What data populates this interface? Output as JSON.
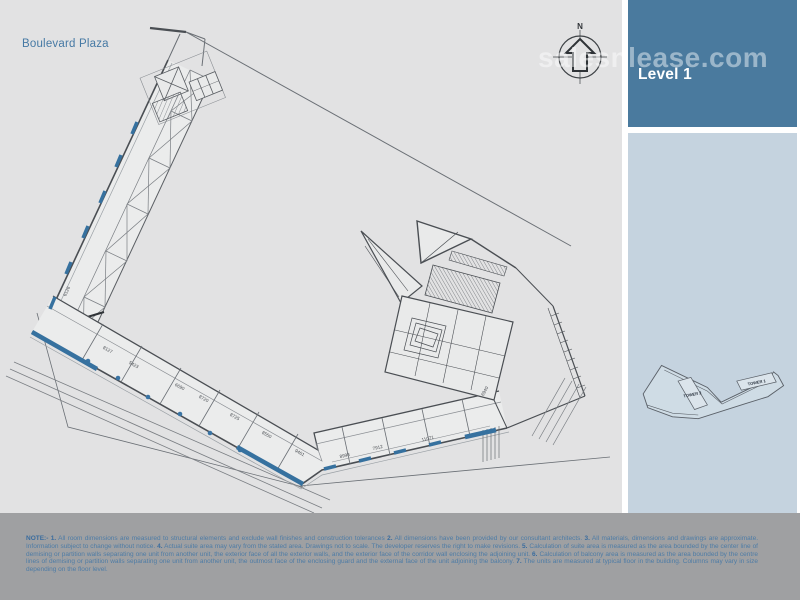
{
  "header": {
    "project_name": "Boulevard Plaza",
    "watermark": "salesnlease.com"
  },
  "sidebar": {
    "level_label": "Level 1"
  },
  "minimap": {
    "tower1_label": "TOWER 1",
    "tower2_label": "TOWER 2"
  },
  "plan": {
    "north_label": "N",
    "dim_labels": [
      "6126",
      "8127",
      "5423",
      "6690",
      "8720",
      "8725",
      "8550",
      "9461",
      "8998",
      "7912",
      "11071",
      "6940"
    ]
  },
  "colors": {
    "accent_blue": "#3a74a4",
    "sidebar_top": "#4a7a9e",
    "sidebar_panel": "#c5d3df",
    "canvas_bg": "#e2e2e3",
    "footer_bg": "#9fa0a2",
    "note_text": "#4e7ca6",
    "title_text": "#4679a4"
  },
  "footer": {
    "segments": [
      {
        "b": true,
        "t": "NOTE:- 1."
      },
      {
        "b": false,
        "t": " All room dimensions are measured to structural elements and exclude wall finishes and construction tolerances "
      },
      {
        "b": true,
        "t": "2."
      },
      {
        "b": false,
        "t": " All dimensions have been provided by our consultant architects. "
      },
      {
        "b": true,
        "t": "3."
      },
      {
        "b": false,
        "t": " All materials, dimensions and drawings are approximate. Information subject to change without notice. "
      },
      {
        "b": true,
        "t": "4."
      },
      {
        "b": false,
        "t": " Actual suite area may vary from the stated area. Drawings not to scale. The developer reserves the right to make revisions. "
      },
      {
        "b": true,
        "t": "5."
      },
      {
        "b": false,
        "t": " Calculation of suite area is measured as the area bounded by the center line of demising or partition walls separating one unit from another unit, the exterior face of all the exterior walls, and the exterior face of the corridor wall enclosing the adjoining unit. "
      },
      {
        "b": true,
        "t": "6."
      },
      {
        "b": false,
        "t": " Calculation of balcony area is measured as the area bounded by the centre lines of demising or partition walls separating one unit from another unit, the outmost face of the enclosing guard and the external face of the unit adjoining the balcony. "
      },
      {
        "b": true,
        "t": "7."
      },
      {
        "b": false,
        "t": " The units are measured at typical floor in the building. Columns may vary in size depending on the floor level."
      }
    ]
  }
}
